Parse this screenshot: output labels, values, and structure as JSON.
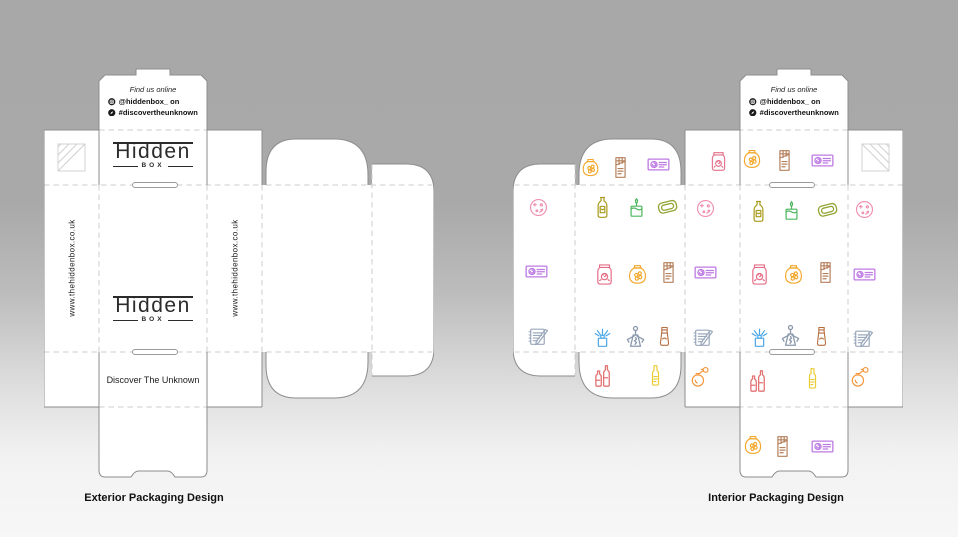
{
  "page": {
    "captions": {
      "exterior": "Exterior Packaging Design",
      "interior": "Interior Packaging Design"
    }
  },
  "branding": {
    "find_us_title": "Find us online",
    "instagram_handle": "@hiddenbox_ on",
    "hashtag": "#discovertheunknown",
    "logo_main": "Hidden",
    "logo_sub": "BOX",
    "website": "www.thehiddenbox.co.uk",
    "tagline": "Discover The Unknown"
  },
  "dieline_style": {
    "panel_color": "#ffffff",
    "cut_line_color": "#8d8d8d",
    "fold_line_color": "#cdcdcd",
    "glue_mark_color": "#cfcfcf"
  },
  "icon_colors": {
    "bath-bomb": "#f08bab",
    "gift-voucher": "#bd7ae3",
    "notebook": "#9aa8bb",
    "perfume-atomizer": "#f5953b",
    "jam-jar": "#e56f88",
    "honey-pot": "#f3a82d",
    "chocolate-bar": "#b5805c",
    "olive-oil-bottle": "#a89a1a",
    "candle": "#4cb65e",
    "soap-bar": "#93a433",
    "reed-diffuser": "#4aa7e8",
    "corkscrew": "#8a98ab",
    "lotion-tube": "#b76e40",
    "wine-bottles": "#e27373",
    "yellow-bottle": "#eacc35"
  },
  "interior_icons": [
    {
      "name": "bath-bomb",
      "x": 25,
      "y": 139,
      "size": 23,
      "color": "#f08bab"
    },
    {
      "name": "gift-voucher",
      "x": 23,
      "y": 203,
      "size": 27,
      "color": "#bd7ae3"
    },
    {
      "name": "notebook",
      "x": 25,
      "y": 268,
      "size": 25,
      "color": "#9aa8bb"
    },
    {
      "name": "honey-pot",
      "x": 77,
      "y": 100,
      "size": 23,
      "color": "#f3a82d"
    },
    {
      "name": "chocolate-bar",
      "x": 107,
      "y": 99,
      "size": 25,
      "color": "#b5805c"
    },
    {
      "name": "gift-voucher",
      "x": 145,
      "y": 96,
      "size": 27,
      "color": "#bd7ae3"
    },
    {
      "name": "olive-oil-bottle",
      "x": 89,
      "y": 139,
      "size": 25,
      "color": "#a89a1a"
    },
    {
      "name": "candle",
      "x": 123,
      "y": 140,
      "size": 25,
      "color": "#4cb65e"
    },
    {
      "name": "soap-bar",
      "x": 154,
      "y": 138,
      "size": 27,
      "color": "#93a433"
    },
    {
      "name": "jam-jar",
      "x": 91,
      "y": 206,
      "size": 25,
      "color": "#e56f88"
    },
    {
      "name": "honey-pot",
      "x": 124,
      "y": 207,
      "size": 25,
      "color": "#f3a82d"
    },
    {
      "name": "chocolate-bar",
      "x": 155,
      "y": 204,
      "size": 25,
      "color": "#b5805c"
    },
    {
      "name": "reed-diffuser",
      "x": 89,
      "y": 268,
      "size": 25,
      "color": "#4aa7e8"
    },
    {
      "name": "corkscrew",
      "x": 122,
      "y": 269,
      "size": 27,
      "color": "#8a98ab"
    },
    {
      "name": "lotion-tube",
      "x": 151,
      "y": 268,
      "size": 23,
      "color": "#b76e40"
    },
    {
      "name": "wine-bottles",
      "x": 89,
      "y": 307,
      "size": 27,
      "color": "#e27373"
    },
    {
      "name": "yellow-bottle",
      "x": 142,
      "y": 307,
      "size": 25,
      "color": "#eacc35"
    },
    {
      "name": "jam-jar",
      "x": 205,
      "y": 93,
      "size": 23,
      "color": "#e56f88"
    },
    {
      "name": "bath-bomb",
      "x": 192,
      "y": 140,
      "size": 23,
      "color": "#f08bab"
    },
    {
      "name": "gift-voucher",
      "x": 192,
      "y": 204,
      "size": 27,
      "color": "#bd7ae3"
    },
    {
      "name": "notebook",
      "x": 190,
      "y": 269,
      "size": 25,
      "color": "#9aa8bb"
    },
    {
      "name": "perfume-atomizer",
      "x": 187,
      "y": 308,
      "size": 25,
      "color": "#f5953b"
    },
    {
      "name": "honey-pot",
      "x": 239,
      "y": 92,
      "size": 24,
      "color": "#f3a82d"
    },
    {
      "name": "chocolate-bar",
      "x": 271,
      "y": 92,
      "size": 25,
      "color": "#b5805c"
    },
    {
      "name": "gift-voucher",
      "x": 309,
      "y": 92,
      "size": 27,
      "color": "#bd7ae3"
    },
    {
      "name": "olive-oil-bottle",
      "x": 245,
      "y": 143,
      "size": 25,
      "color": "#a89a1a"
    },
    {
      "name": "candle",
      "x": 278,
      "y": 143,
      "size": 25,
      "color": "#4cb65e"
    },
    {
      "name": "soap-bar",
      "x": 314,
      "y": 141,
      "size": 27,
      "color": "#93a433"
    },
    {
      "name": "jam-jar",
      "x": 246,
      "y": 206,
      "size": 25,
      "color": "#e56f88"
    },
    {
      "name": "honey-pot",
      "x": 280,
      "y": 207,
      "size": 25,
      "color": "#f3a82d"
    },
    {
      "name": "chocolate-bar",
      "x": 312,
      "y": 204,
      "size": 25,
      "color": "#b5805c"
    },
    {
      "name": "reed-diffuser",
      "x": 246,
      "y": 268,
      "size": 25,
      "color": "#4aa7e8"
    },
    {
      "name": "corkscrew",
      "x": 277,
      "y": 268,
      "size": 27,
      "color": "#8a98ab"
    },
    {
      "name": "lotion-tube",
      "x": 308,
      "y": 268,
      "size": 23,
      "color": "#b76e40"
    },
    {
      "name": "wine-bottles",
      "x": 244,
      "y": 312,
      "size": 27,
      "color": "#e27373"
    },
    {
      "name": "yellow-bottle",
      "x": 299,
      "y": 310,
      "size": 25,
      "color": "#eacc35"
    },
    {
      "name": "honey-pot",
      "x": 240,
      "y": 378,
      "size": 24,
      "color": "#f3a82d"
    },
    {
      "name": "chocolate-bar",
      "x": 269,
      "y": 378,
      "size": 25,
      "color": "#b5805c"
    },
    {
      "name": "gift-voucher",
      "x": 309,
      "y": 378,
      "size": 27,
      "color": "#bd7ae3"
    },
    {
      "name": "bath-bomb",
      "x": 351,
      "y": 141,
      "size": 23,
      "color": "#f08bab"
    },
    {
      "name": "gift-voucher",
      "x": 351,
      "y": 206,
      "size": 27,
      "color": "#bd7ae3"
    },
    {
      "name": "notebook",
      "x": 350,
      "y": 270,
      "size": 25,
      "color": "#9aa8bb"
    },
    {
      "name": "perfume-atomizer",
      "x": 347,
      "y": 308,
      "size": 25,
      "color": "#f5953b"
    }
  ]
}
